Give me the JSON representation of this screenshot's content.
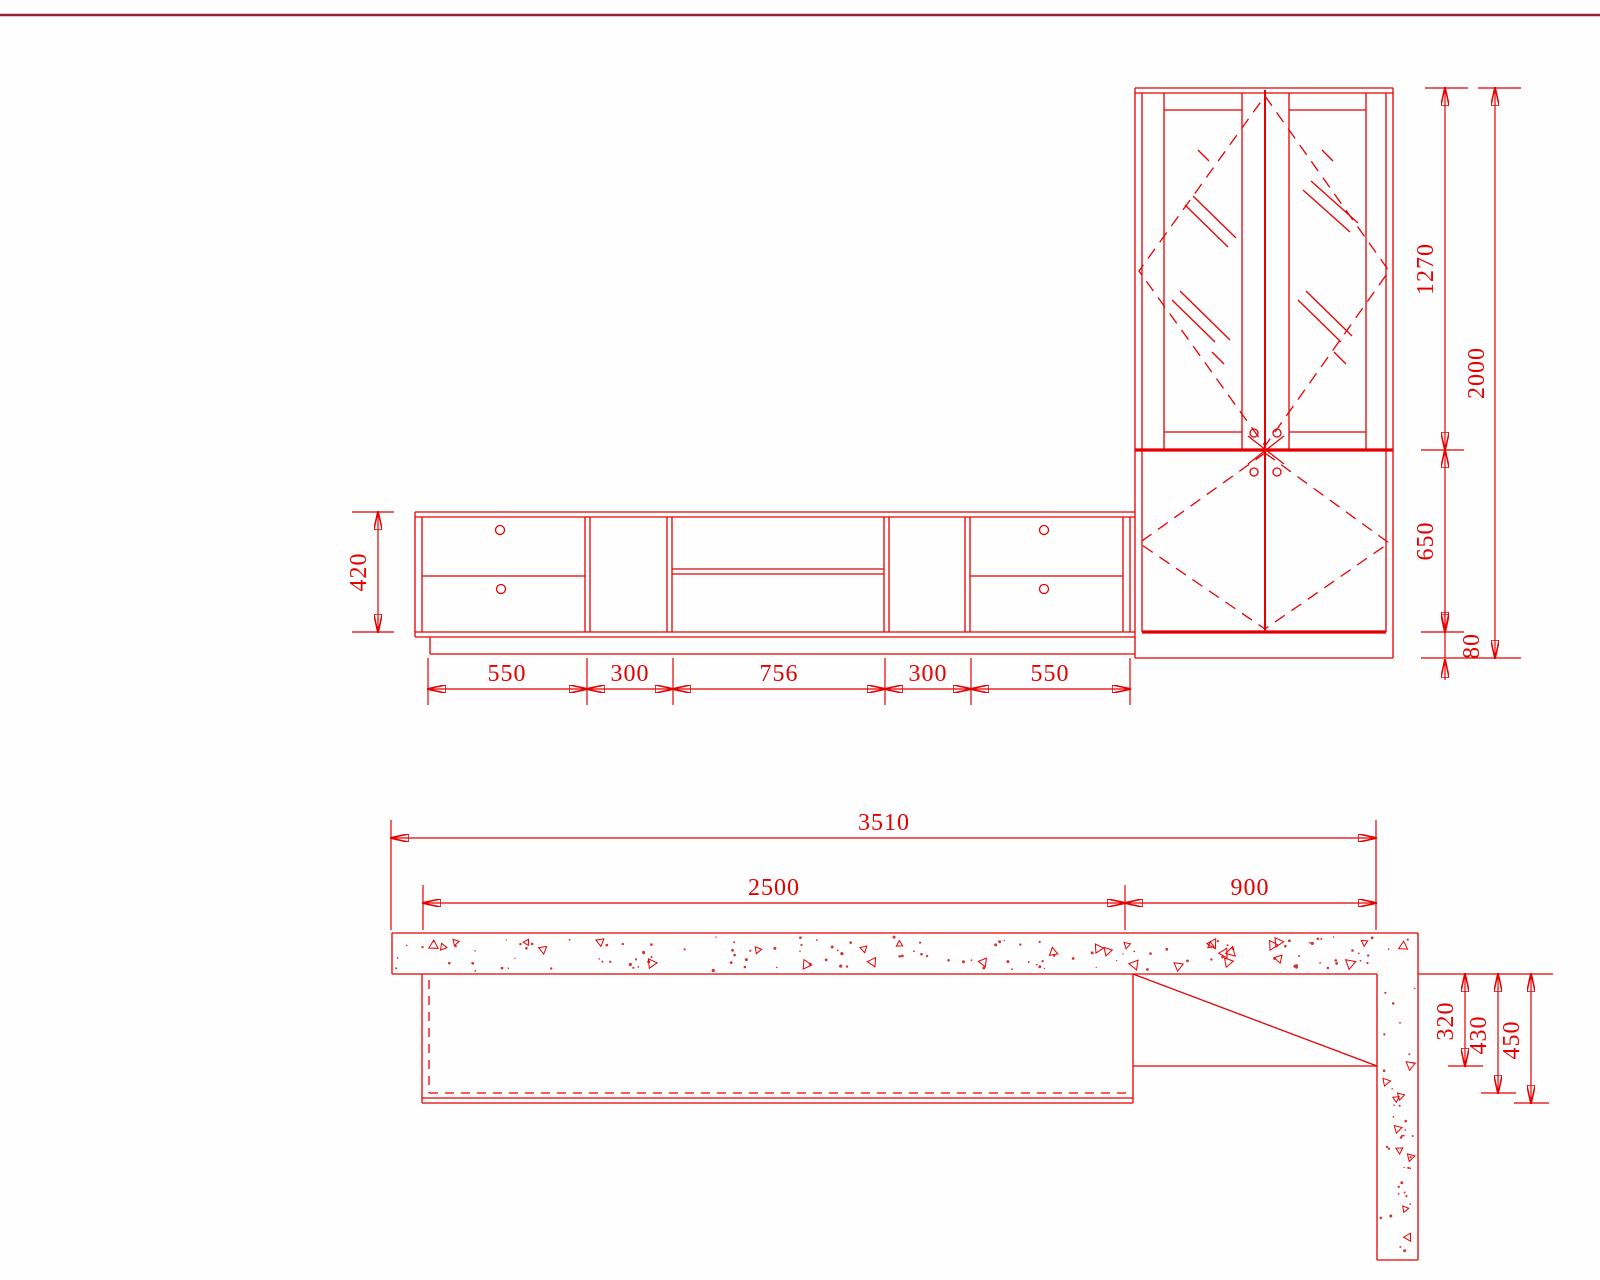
{
  "drawing": {
    "kind": "cad-furniture-drawing",
    "colors": {
      "line": "#e60000",
      "top_rule": "#93222f",
      "background": "#ffffff"
    },
    "elevation": {
      "dim_body_height": "420",
      "dims_bottom": [
        "550",
        "300",
        "756",
        "300",
        "550"
      ],
      "dim_glass_door_height": "1270",
      "dim_total_height": "2000",
      "dim_lower_door_height": "650",
      "dim_plinth_height": "80"
    },
    "plan": {
      "dim_total_width": "3510",
      "dim_tv_unit_width": "2500",
      "dim_cabinet_width": "900",
      "dim_cabinet_depth": "320",
      "dim_tv_depth_inner": "430",
      "dim_tv_depth": "450"
    }
  }
}
